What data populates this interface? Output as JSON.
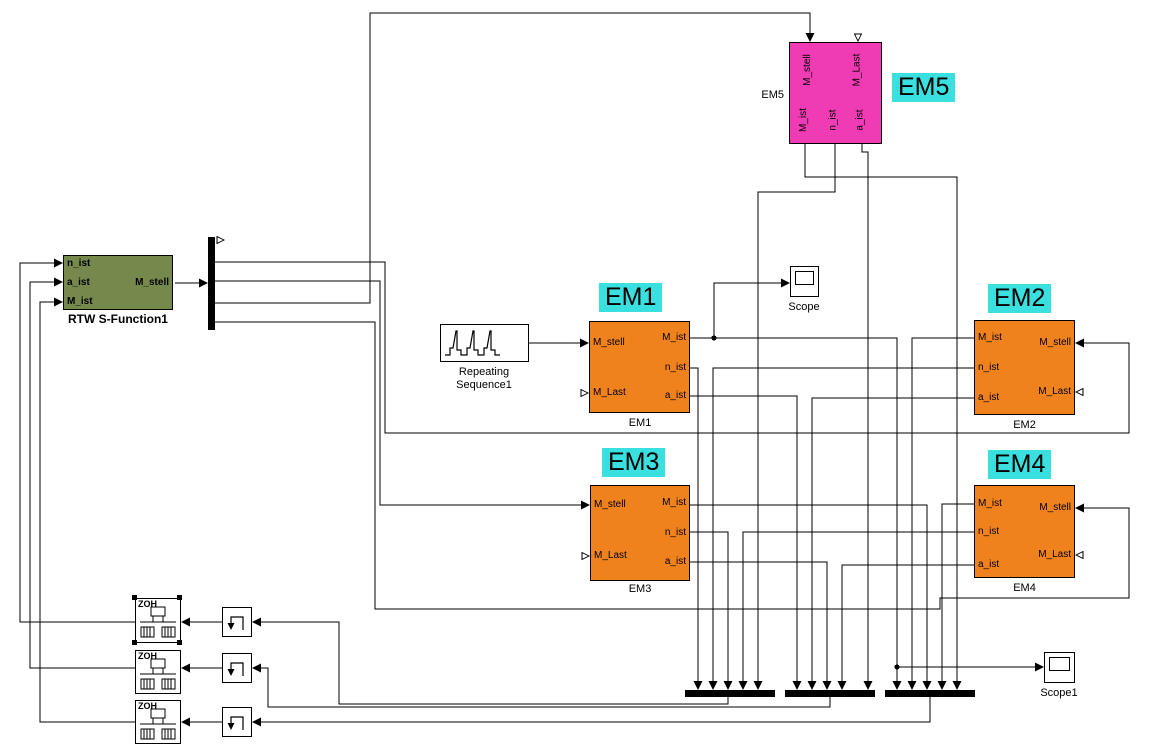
{
  "colors": {
    "em_orange": "#F0821E",
    "em5_magenta": "#F03CB4",
    "label_cyan": "#3AE0E0",
    "rtw_green": "#75894D",
    "wire": "#000000",
    "canvas": "#FFFFFF"
  },
  "blocks": {
    "rtw": {
      "caption": "RTW S-Function1",
      "in1": "n_ist",
      "in2": "a_ist",
      "in3": "M_ist",
      "out1": "M_stell"
    },
    "repeating_sequence": {
      "caption_line1": "Repeating",
      "caption_line2": "Sequence1"
    },
    "em1": {
      "caption": "EM1",
      "tag": "EM1",
      "in_top": "M_stell",
      "in_bottom": "M_Last",
      "out1": "M_ist",
      "out2": "n_ist",
      "out3": "a_ist"
    },
    "em2": {
      "caption": "EM2",
      "tag": "EM2",
      "out1": "M_ist",
      "out2": "n_ist",
      "out3": "a_ist",
      "in_top": "M_stell",
      "in_bottom": "M_Last"
    },
    "em3": {
      "caption": "EM3",
      "tag": "EM3",
      "in_top": "M_stell",
      "in_bottom": "M_Last",
      "out1": "M_ist",
      "out2": "n_ist",
      "out3": "a_ist"
    },
    "em4": {
      "caption": "EM4",
      "tag": "EM4",
      "out1": "M_ist",
      "out2": "n_ist",
      "out3": "a_ist",
      "in_top": "M_stell",
      "in_bottom": "M_Last"
    },
    "em5": {
      "caption": "EM5",
      "name_label": "EM5",
      "tag": "EM5",
      "in_top_left": "M_stell",
      "in_top_right": "M_Last",
      "out1": "M_ist",
      "out2": "n_ist",
      "out3": "a_ist"
    },
    "scope": {
      "caption": "Scope"
    },
    "scope1": {
      "caption": "Scope1"
    },
    "zoh1": {
      "label": "ZOH"
    },
    "zoh2": {
      "label": "ZOH"
    },
    "zoh3": {
      "label": "ZOH"
    }
  }
}
